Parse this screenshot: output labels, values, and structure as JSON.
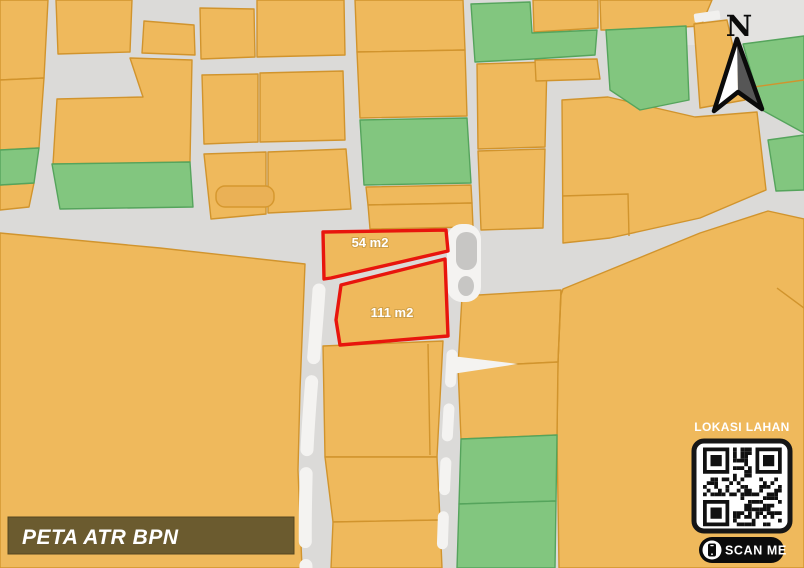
{
  "palette": {
    "parcel_fill": "#EFB95C",
    "parcel_border": "#D1942D",
    "green_fill": "#82C67F",
    "green_border": "#55A45C",
    "road_gray": "#DBDAD8",
    "road_white": "#F4F3F1",
    "highlight_red": "#E8150D",
    "banner_bg": "#6B5B2F",
    "compass_dark": "#565656",
    "pill_black": "#0B0B0B",
    "text_white": "#FFFFFF"
  },
  "map": {
    "plot_labels": {
      "plot54": "54 m2",
      "plot111": "111 m2"
    },
    "compass_label": "N",
    "qr_panel": {
      "title": "LOKASI LAHAN",
      "scan_label": "SCAN ME"
    },
    "banner_title": "PETA ATR BPN"
  }
}
